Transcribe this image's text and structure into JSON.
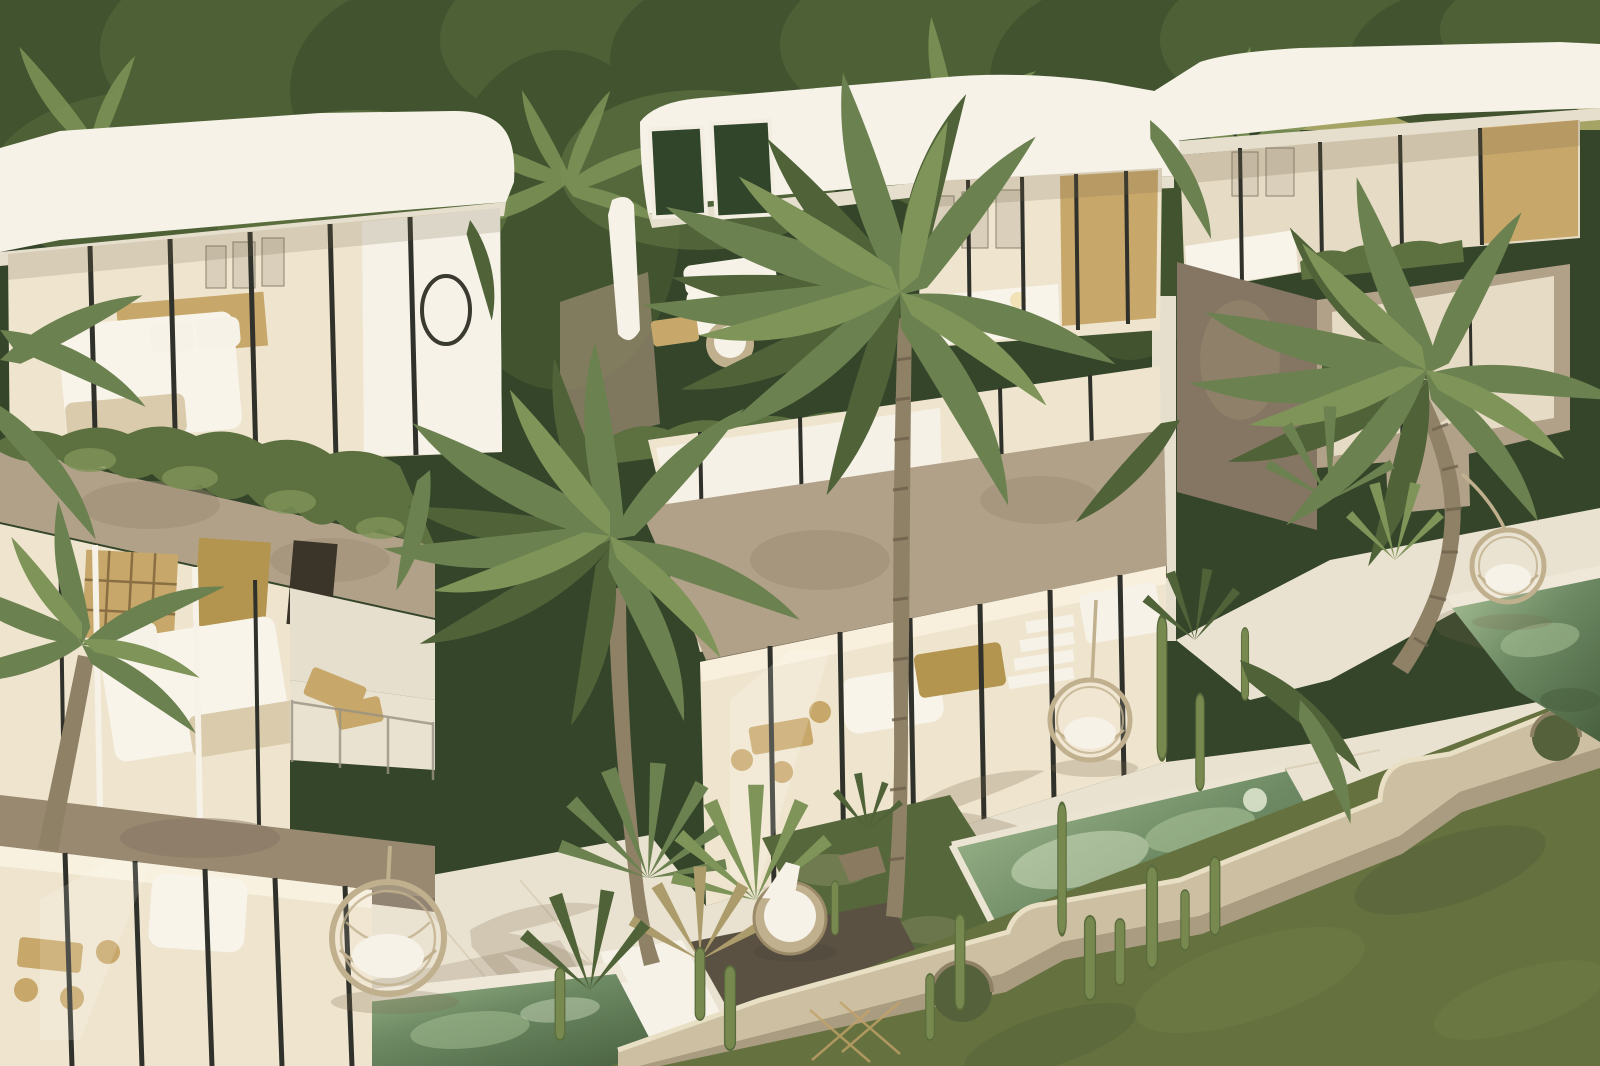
{
  "scene": {
    "kind": "3d-architectural-render",
    "description": "Aerial render of three modern white box villas with taupe concrete balconies, glass walls, rooftop terraces, hanging rattan egg chairs, tropical palms, cactus beds, green plunge pools, a beige perimeter wall with round cutouts and an olive lawn, backed by dense jungle canopy.",
    "objects": [
      "villa-left",
      "villa-center",
      "villa-right",
      "rooftop-terrace",
      "balcony-with-ivy",
      "bedroom-interiors",
      "living-room-interiors",
      "palm-trees",
      "fan-palms",
      "cactus-garden",
      "plunge-pool-left",
      "plunge-pool-center",
      "plunge-pool-right",
      "hanging-egg-chairs",
      "round-lounge-chair",
      "wooden-loungers",
      "perimeter-wall-with-round-openings",
      "lawn",
      "jungle-canopy"
    ]
  },
  "colors": {
    "canopyDeep": "#34452a",
    "canopyDark": "#41542f",
    "canopyMid": "#4e6136",
    "canopyLight": "#5d7040",
    "palm": "#6c8150",
    "palmBright": "#7f9458",
    "palmDark": "#4f6238",
    "palmDry": "#ac9c6c",
    "field": "#a5a464",
    "white": "#f6f2e8",
    "whiteShade": "#e7dfcd",
    "whiteDeep": "#d9cfba",
    "concrete": "#b1a189",
    "concreteDark": "#988970",
    "concreteDeep": "#857663",
    "glass": "#efe5cf",
    "glassCool": "#e6dcc6",
    "glassDark": "#31452a",
    "mullion": "#30312a",
    "wood": "#c7a76a",
    "woodDeep": "#b3954f",
    "tvDark": "#3a3429",
    "curtain": "#f6f1e6",
    "bedWhite": "#f8f4ea",
    "blanket": "#d9cbab",
    "patio": "#eae2d0",
    "patioShade": "#cdbfa6",
    "pool": "#6d8a64",
    "poolDark": "#49603f",
    "poolLight": "#a8c096",
    "poolPale": "#cfdcbe",
    "grassCourt": "#57673c",
    "lawn": "#65713e",
    "lawnDark": "#55613a",
    "soil": "#5a5142",
    "wall": "#ccbfa2",
    "wallShade": "#aa9c80",
    "wallLight": "#e9dfc5",
    "rattan": "#c0b08d",
    "cushion": "#f6f2e8",
    "trunk": "#8e8166",
    "trunkDark": "#6d614c",
    "cactus": "#77894f",
    "cactusDark": "#5a6b3c"
  }
}
